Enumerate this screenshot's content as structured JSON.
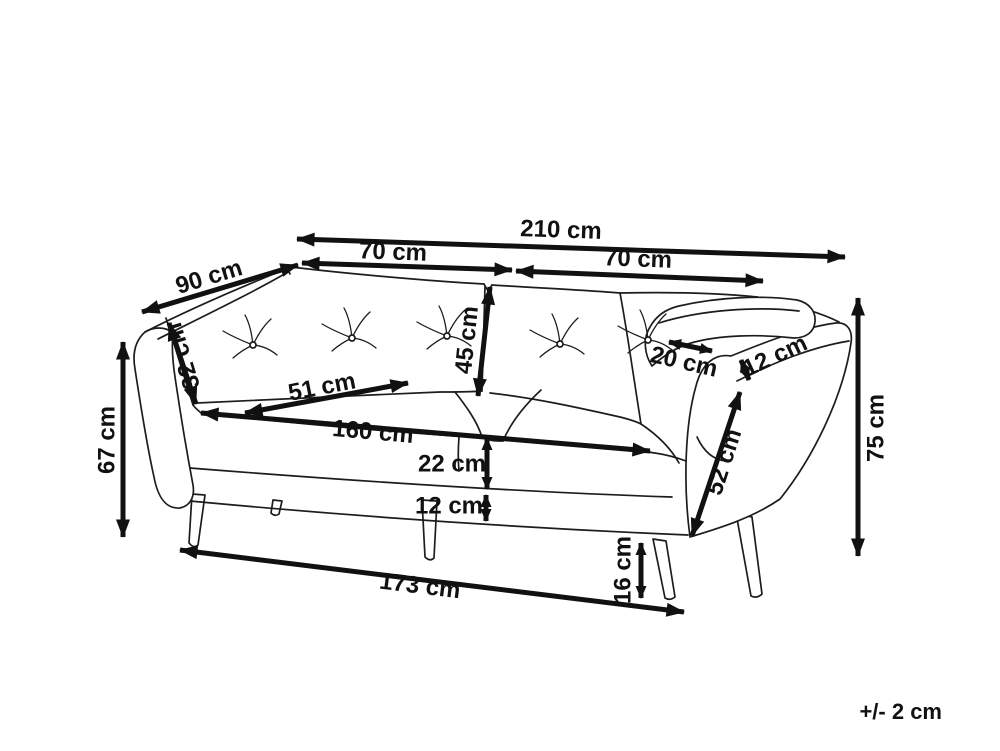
{
  "diagram": {
    "type": "furniture-dimension-drawing",
    "subject": "3-seater sofa line drawing with measurements",
    "unit": "cm",
    "tolerance_note": "+/- 2 cm",
    "line_color": "#1d1d1d",
    "dimension_color": "#111111",
    "background": "#ffffff",
    "dimensions": [
      {
        "id": "total-width",
        "label": "210 cm",
        "value": 210
      },
      {
        "id": "seat-section-left",
        "label": "70 cm",
        "value": 70
      },
      {
        "id": "seat-section-right",
        "label": "70 cm",
        "value": 70
      },
      {
        "id": "depth",
        "label": "90 cm",
        "value": 90
      },
      {
        "id": "back-cushion-height",
        "label": "32 cm",
        "value": 32
      },
      {
        "id": "backrest-height",
        "label": "45 cm",
        "value": 45
      },
      {
        "id": "seat-depth",
        "label": "51 cm",
        "value": 51
      },
      {
        "id": "seat-width",
        "label": "160 cm",
        "value": 160
      },
      {
        "id": "armrest-top-width",
        "label": "20 cm",
        "value": 20
      },
      {
        "id": "armrest-top-thickness",
        "label": "12 cm",
        "value": 12
      },
      {
        "id": "seat-cushion-height",
        "label": "22 cm",
        "value": 22
      },
      {
        "id": "base-height",
        "label": "12 cm",
        "value": 12
      },
      {
        "id": "armrest-height-left",
        "label": "67 cm",
        "value": 67
      },
      {
        "id": "base-width",
        "label": "173 cm",
        "value": 173
      },
      {
        "id": "leg-height",
        "label": "16 cm",
        "value": 16
      },
      {
        "id": "armrest-outer-height",
        "label": "52 cm",
        "value": 52
      },
      {
        "id": "total-height",
        "label": "75 cm",
        "value": 75
      }
    ]
  }
}
